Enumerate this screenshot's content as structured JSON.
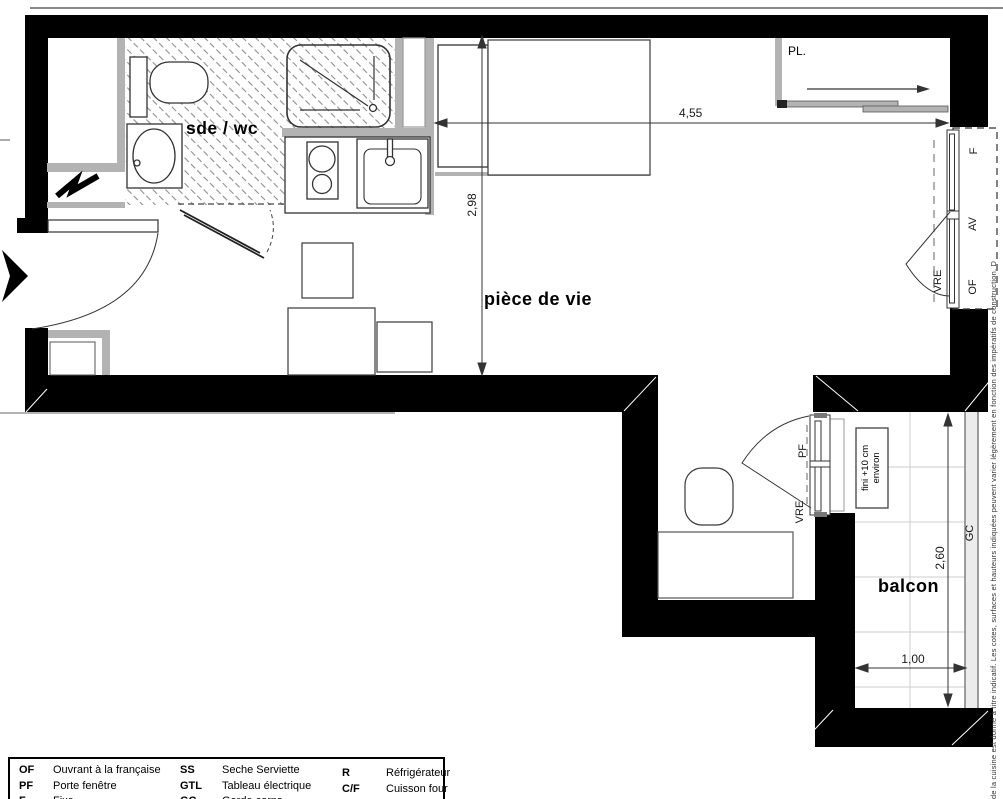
{
  "plan": {
    "rooms": {
      "bathroom_label": "sde / wc",
      "living_label": "pièce de vie",
      "balcony_label": "balcon",
      "closet_label": "PL."
    },
    "dimensions": {
      "living_width_m": "4,55",
      "living_depth_m": "2,98",
      "balcony_depth_m": "2,60",
      "balcony_width_m": "1,00"
    },
    "openings": {
      "fixed_pane": "F",
      "av_code": "AV",
      "french_opening": "OF",
      "roller_shutter_right": "VRE",
      "balcony_door": "PF",
      "roller_shutter_balcony": "VRE",
      "guardrail": "GC"
    },
    "notes": {
      "balcony_level_line1": "fini +10 cm",
      "balcony_level_line2": "environ"
    },
    "disclaimer": "de la cuisine est donné à titre indicatif. Les cotes, surfaces et hauteurs indiquées peuvent varier légèrement en fonction des impératifs de construction. D"
  },
  "legend": {
    "items": [
      {
        "key": "OF",
        "label": "Ouvrant à la française"
      },
      {
        "key": "PF",
        "label": "Porte fenêtre"
      },
      {
        "key": "F",
        "label": "Fixe"
      },
      {
        "key": "SS",
        "label": "Seche Serviette"
      },
      {
        "key": "GTL",
        "label": "Tableau électrique"
      },
      {
        "key": "GC",
        "label": "Garde corps"
      },
      {
        "key": "R",
        "label": "Réfrigérateur"
      },
      {
        "key": "C/F",
        "label": "Cuisson four"
      },
      {
        "key": "hatch",
        "label": "Faux plafond"
      }
    ]
  }
}
